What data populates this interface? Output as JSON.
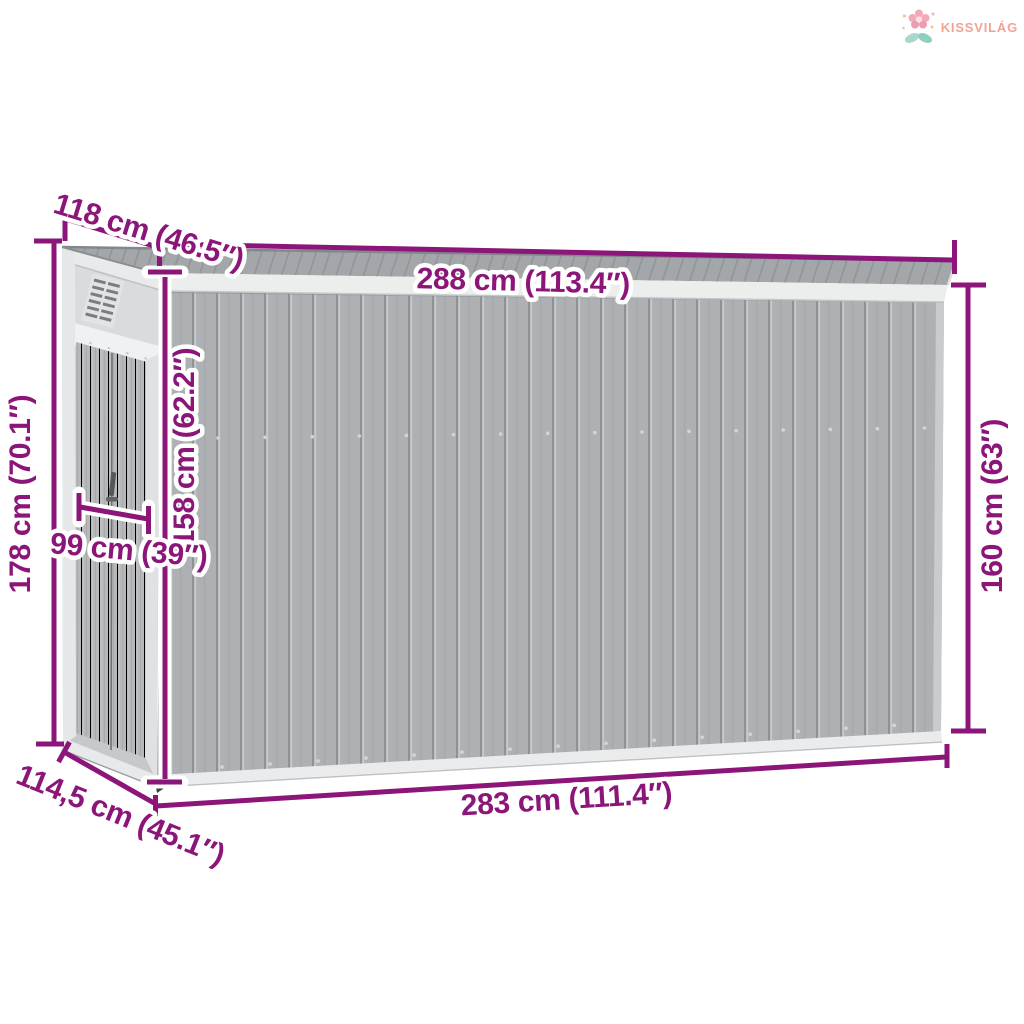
{
  "brand": {
    "name": "KISSVILÁG"
  },
  "dimensions": {
    "roof_depth": "118 cm (46.5″)",
    "roof_width": "288 cm (113.4″)",
    "back_height": "178 cm (70.1″)",
    "inner_front_height": "158 cm (62.2″)",
    "door_width": "99 cm (39″)",
    "base_depth": "114,5 cm (45.1″)",
    "base_width": "283 cm (111.4″)",
    "front_height": "160 cm (63″)"
  },
  "colors": {
    "dimension_accent": "#8B1579",
    "brand_text": "#F2A392",
    "wall_gray": "#AEB1B3",
    "roof_gray": "#A4A7AA",
    "trim_white": "#ECEDED"
  }
}
